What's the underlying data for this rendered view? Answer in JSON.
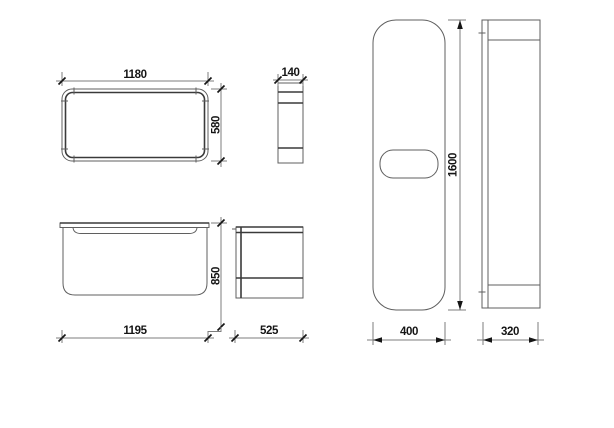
{
  "colors": {
    "background": "#ffffff",
    "line_thin": "#5f5f5f",
    "line_strong": "#3a3a3a",
    "dimension": "#7d7d7d",
    "marks": "#151515"
  },
  "views": {
    "plan": {
      "width": "1180",
      "height": "580"
    },
    "rim_profile": {
      "width": "140"
    },
    "front": {
      "width": "1195",
      "height": "850"
    },
    "side": {
      "width": "525"
    },
    "panel_front": {
      "width": "400",
      "height": "1600"
    },
    "panel_side": {
      "width": "320"
    }
  }
}
